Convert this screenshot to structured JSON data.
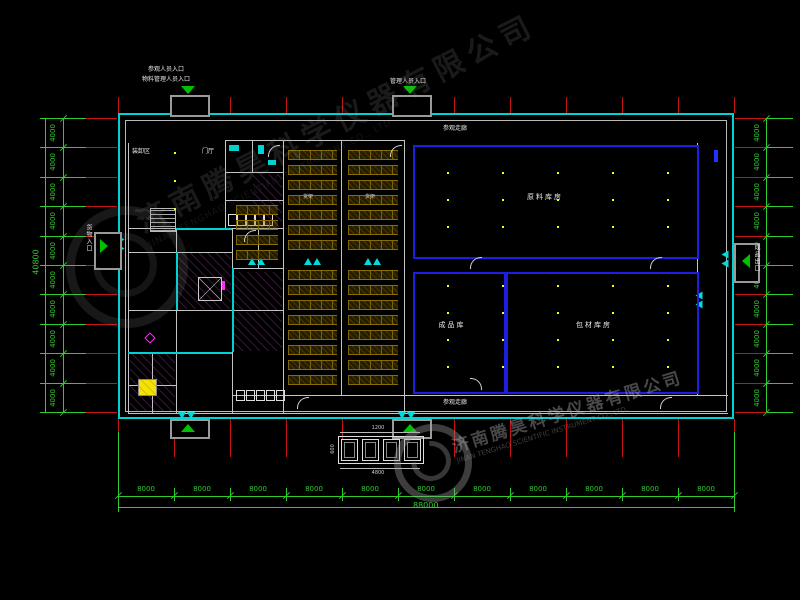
{
  "canvas": {
    "width": 800,
    "height": 600,
    "background": "#000000"
  },
  "colors": {
    "outer_wall_cyan": "#00d2d2",
    "inner_wall_gray": "#c4c4c4",
    "grid_red": "#c41414",
    "dimension_green": "#2ecc2e",
    "room_blue": "#1e1ee0",
    "rack_gold": "#8a6d00",
    "hatch_purple": "#b44ab4",
    "highlight_yellow": "#f2e400",
    "column_yellow": "#ffff00",
    "entry_green": "#00c000",
    "accent_magenta": "#ff2bff"
  },
  "entrances": {
    "top_left_line1": "参观人员入口",
    "top_left_line2": "物料管理人员入口",
    "top_right": "管理人员入口",
    "left_side": "货物入口",
    "right_side": "成品出口"
  },
  "areas": {
    "lobby_left": "装卸区",
    "lobby_right": "门厅",
    "corridor_top": "参观走廊",
    "corridor_bottom": "参观走廊",
    "rack_label": "货架",
    "room_a": "原料库房",
    "room_b": "成品库",
    "room_c": "包材库房"
  },
  "dimensions": {
    "bottom_segment": "8000",
    "bottom_count": 11,
    "bottom_total": "88000",
    "side_segment": "4000",
    "side_count": 10,
    "side_total": "40800",
    "detail_top": "1200",
    "detail_left": "600",
    "detail_bottom": "4800"
  },
  "watermark": {
    "company_cn": "济南腾昊科学仪器有限公司",
    "company_en": "JINAN TENGHAO SCIENTIFIC INSTRUMENT CO., LTD."
  }
}
